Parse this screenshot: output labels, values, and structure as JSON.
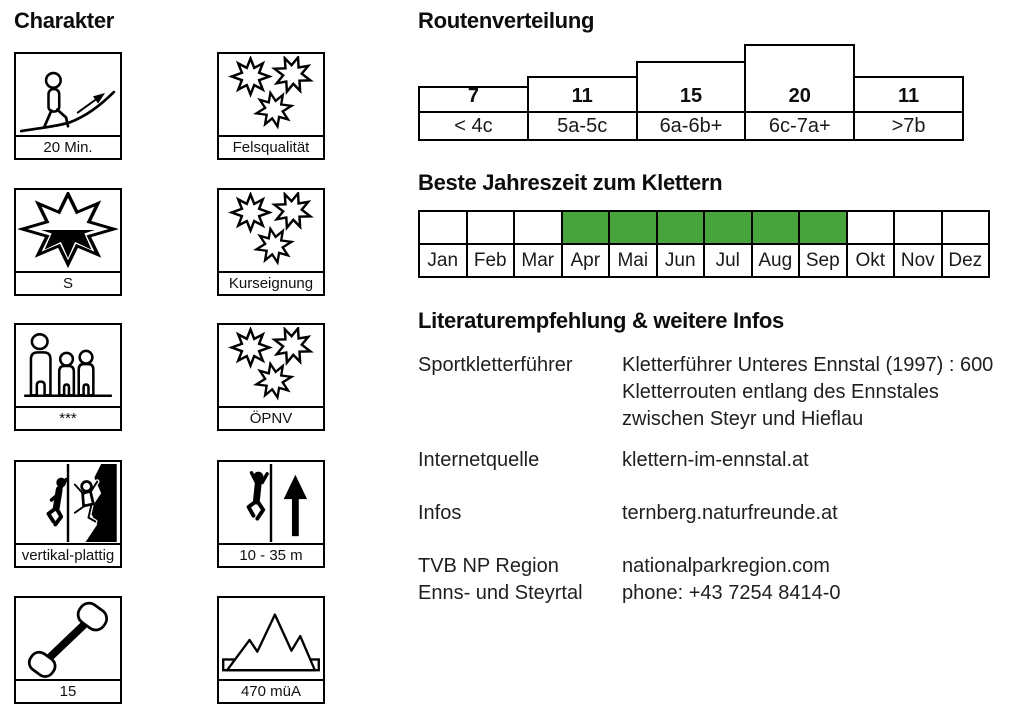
{
  "charakter": {
    "heading": "Charakter",
    "left": [
      {
        "label": "20 Min."
      },
      {
        "label": "S"
      },
      {
        "label": "***"
      },
      {
        "label": "vertikal-plattig"
      },
      {
        "label": "15"
      }
    ],
    "right": [
      {
        "label": "Felsqualität"
      },
      {
        "label": "Kurseignung"
      },
      {
        "label": "ÖPNV"
      },
      {
        "label": "10 - 35 m"
      },
      {
        "label": "470 müA"
      }
    ]
  },
  "routenverteilung": {
    "heading": "Routenverteilung",
    "columns": [
      {
        "count": "7",
        "grade": "< 4c"
      },
      {
        "count": "11",
        "grade": "5a-5c"
      },
      {
        "count": "15",
        "grade": "6a-6b+"
      },
      {
        "count": "20",
        "grade": "6c-7a+"
      },
      {
        "count": "11",
        "grade": ">7b"
      }
    ]
  },
  "jahreszeit": {
    "heading": "Beste Jahreszeit zum Klettern",
    "highlight_color": "#47a33c",
    "months": [
      {
        "label": "Jan",
        "state": ""
      },
      {
        "label": "Feb",
        "state": ""
      },
      {
        "label": "Mar",
        "state": ""
      },
      {
        "label": "Apr",
        "state": "active"
      },
      {
        "label": "Mai",
        "state": "active"
      },
      {
        "label": "Jun",
        "state": "active"
      },
      {
        "label": "Jul",
        "state": "active"
      },
      {
        "label": "Aug",
        "state": "active"
      },
      {
        "label": "Sep",
        "state": "active"
      },
      {
        "label": "Okt",
        "state": ""
      },
      {
        "label": "Nov",
        "state": ""
      },
      {
        "label": "Dez",
        "state": ""
      }
    ]
  },
  "literatur": {
    "heading": "Literaturempfehlung & weitere Infos",
    "rows": [
      {
        "label_lines": [
          "Sportkletterführer"
        ],
        "value_lines": [
          "Kletterführer Unteres Ennstal (1997) : 600",
          "Kletterrouten entlang des Ennstales",
          "zwischen Steyr und Hieflau"
        ]
      },
      {
        "label_lines": [
          "Internetquelle"
        ],
        "value_lines": [
          "klettern-im-ennstal.at"
        ]
      },
      {
        "label_lines": [
          "Infos"
        ],
        "value_lines": [
          "ternberg.naturfreunde.at"
        ]
      },
      {
        "label_lines": [
          "TVB NP Region",
          "Enns- und Steyrtal"
        ],
        "value_lines": [
          "nationalparkregion.com",
          "phone: +43 7254 8414-0"
        ]
      }
    ]
  },
  "chart_data": [
    {
      "type": "bar",
      "title": "Routenverteilung",
      "categories": [
        "< 4c",
        "5a-5c",
        "6a-6b+",
        "6c-7a+",
        ">7b"
      ],
      "values": [
        7,
        11,
        15,
        20,
        11
      ],
      "xlabel": "",
      "ylabel": "",
      "ylim": [
        0,
        20
      ],
      "grid": false,
      "legend": "none"
    },
    {
      "type": "heatmap",
      "title": "Beste Jahreszeit zum Klettern",
      "categories": [
        "Jan",
        "Feb",
        "Mar",
        "Apr",
        "Mai",
        "Jun",
        "Jul",
        "Aug",
        "Sep",
        "Okt",
        "Nov",
        "Dez"
      ],
      "values": [
        0,
        0,
        0,
        1,
        1,
        1,
        1,
        1,
        1,
        0,
        0,
        0
      ],
      "highlight_color": "#47a33c"
    }
  ]
}
